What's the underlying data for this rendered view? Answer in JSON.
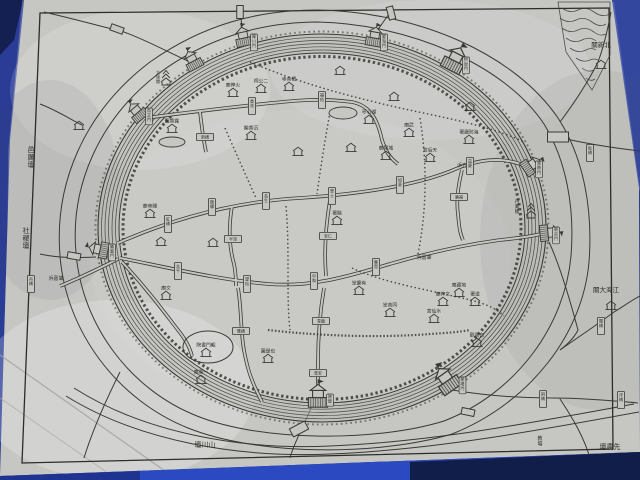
{
  "scene": {
    "description": "photograph of a hand-drawn historical Chinese walled-city map (circular city wall, moat, canals, gates) laminated sheet on blue table",
    "palette": {
      "sheet": "#c6c7c3",
      "sheet_shade": "#b7b8b4",
      "line": "#3a3a34",
      "text": "#2e2e28",
      "bg_blue": "#22357f",
      "left_blue": "#2a3c96",
      "corner_blue": "#33479f",
      "table_blue": "#2b49c0",
      "dark_blue": "#0e1838"
    }
  },
  "map": {
    "rivers": [
      "肇嘉浜",
      "方浜"
    ],
    "landmarks_outside": [
      "北新關",
      "江海大關",
      "邑厲壇",
      "社稷壇",
      "山川壇",
      "先農壇",
      "教場"
    ],
    "gates": [
      "尚文門",
      "拱辰門",
      "障川門",
      "晏海門",
      "寶帶門",
      "朝宗門",
      "朝陽門",
      "跨龍門",
      "儀鳳門"
    ],
    "features": [
      {
        "id": "label-yilitan",
        "type": "label",
        "x": 31,
        "y": 152,
        "text": "邑厲壇",
        "o": "v",
        "fs": 7
      },
      {
        "id": "label-shejitan",
        "type": "label",
        "x": 26,
        "y": 233,
        "text": "社稷壇",
        "o": "v",
        "fs": 7
      },
      {
        "id": "label-zhaojiabang-west",
        "type": "label",
        "x": 56,
        "y": 280,
        "text": "浜嘉肇",
        "o": "h",
        "fs": 5
      },
      {
        "id": "label-beixinguan",
        "type": "label",
        "x": 601,
        "y": 47,
        "text": "關新北",
        "o": "h",
        "fs": 6.5
      },
      {
        "id": "label-jianghaidaguan",
        "type": "label",
        "x": 606,
        "y": 292,
        "text": "關大海江",
        "o": "h",
        "fs": 6.5
      },
      {
        "id": "label-shanchuantan",
        "type": "label",
        "x": 205,
        "y": 447,
        "text": "壇川山",
        "o": "h",
        "fs": 7
      },
      {
        "id": "label-xiannongtan",
        "type": "label",
        "x": 610,
        "y": 449,
        "text": "壇農先",
        "o": "h",
        "fs": 7
      },
      {
        "id": "label-jiaochang",
        "type": "label",
        "x": 540,
        "y": 440,
        "text": "教場",
        "o": "v",
        "fs": 5
      },
      {
        "id": "label-zhaojiabang-east",
        "type": "label",
        "x": 424,
        "y": 259,
        "text": "浜嘉肇",
        "o": "h",
        "fs": 5
      },
      {
        "id": "label-fangbang",
        "type": "label",
        "x": 462,
        "y": 167,
        "text": "浜方",
        "o": "h",
        "fs": 5
      },
      {
        "id": "label-danfenglou",
        "type": "label",
        "x": 517,
        "y": 203,
        "text": "丹鳳樓",
        "o": "v",
        "fs": 4.5
      },
      {
        "id": "temple-huoshenmiao",
        "type": "house",
        "x": 233,
        "y": 92,
        "text": "廟神火"
      },
      {
        "id": "shrine-ergongci",
        "type": "house",
        "x": 261,
        "y": 88,
        "text": "祠公二"
      },
      {
        "id": "temple-jishansi",
        "type": "house",
        "x": 289,
        "y": 86,
        "text": "寺善積"
      },
      {
        "id": "temple-chenxiangge",
        "type": "house",
        "x": 251,
        "y": 135,
        "text": "閣香沉"
      },
      {
        "id": "pavilion-huxinting",
        "type": "house",
        "x": 369,
        "y": 119,
        "text": "亭心湖"
      },
      {
        "id": "temple-chenghuangmiao",
        "type": "house",
        "x": 386,
        "y": 155,
        "text": "廟隍城"
      },
      {
        "id": "temple-wumiao",
        "type": "house",
        "x": 409,
        "y": 132,
        "text": "廟武"
      },
      {
        "id": "office-xianshu",
        "type": "house",
        "x": 337,
        "y": 220,
        "text": "署縣"
      },
      {
        "id": "office-haifangting",
        "type": "house",
        "x": 469,
        "y": 139,
        "text": "署廳防海"
      },
      {
        "id": "temple-tianhougong",
        "type": "house",
        "x": 430,
        "y": 157,
        "text": "宮后天"
      },
      {
        "id": "garden-luxiangyuan",
        "type": "house",
        "x": 172,
        "y": 128,
        "text": "園香露"
      },
      {
        "id": "temple-guandimiao",
        "type": "house",
        "x": 150,
        "y": 213,
        "text": "廟帝關"
      },
      {
        "id": "temple-wenmiao",
        "type": "house",
        "x": 166,
        "y": 295,
        "text": "廟文"
      },
      {
        "id": "garden-yeshiyuan",
        "type": "house",
        "x": 268,
        "y": 358,
        "text": "園是也"
      },
      {
        "id": "academy-longmenshuyuan",
        "type": "house",
        "x": 206,
        "y": 352,
        "text": "院書門龍"
      },
      {
        "id": "temple-yisuan",
        "type": "house",
        "x": 201,
        "y": 379,
        "text": "庵粟一"
      },
      {
        "id": "hall-tongshantang",
        "type": "house",
        "x": 390,
        "y": 312,
        "text": "堂善同"
      },
      {
        "id": "temple-shuixiangong",
        "type": "house",
        "x": 434,
        "y": 318,
        "text": "宮仙水"
      },
      {
        "id": "temple-wenshenmiao",
        "type": "house",
        "x": 443,
        "y": 301,
        "text": "廟神文"
      },
      {
        "id": "temple-dizangan",
        "type": "house",
        "x": 459,
        "y": 292,
        "text": "庵藏地"
      },
      {
        "id": "office-daoshu",
        "type": "house",
        "x": 475,
        "y": 301,
        "text": "署道"
      },
      {
        "id": "temple-baiyunguan",
        "type": "house",
        "x": 477,
        "y": 342,
        "text": "觀雲白"
      },
      {
        "id": "hall-youqingtang",
        "type": "house",
        "x": 359,
        "y": 290,
        "text": "堂慶有"
      },
      {
        "id": "house-beixinguan",
        "type": "house",
        "x": 601,
        "y": 64,
        "text": ""
      },
      {
        "id": "house-jianghaidaguan",
        "type": "house",
        "x": 611,
        "y": 305,
        "text": ""
      },
      {
        "id": "house-yilitan",
        "type": "house",
        "x": 79,
        "y": 125,
        "text": ""
      },
      {
        "id": "house-1",
        "type": "house",
        "x": 298,
        "y": 151,
        "text": ""
      },
      {
        "id": "house-2",
        "type": "house",
        "x": 351,
        "y": 147,
        "text": ""
      },
      {
        "id": "house-3",
        "type": "house",
        "x": 470,
        "y": 106,
        "text": ""
      },
      {
        "id": "house-4",
        "type": "house",
        "x": 161,
        "y": 241,
        "text": ""
      },
      {
        "id": "house-5",
        "type": "house",
        "x": 213,
        "y": 242,
        "text": ""
      },
      {
        "id": "house-6",
        "type": "house",
        "x": 394,
        "y": 96,
        "text": ""
      },
      {
        "id": "house-7",
        "type": "house",
        "x": 340,
        "y": 70,
        "text": ""
      },
      {
        "id": "bridge-hongqiao",
        "type": "bridge",
        "x": 168,
        "y": 224,
        "o": "v",
        "text": "虹橋"
      },
      {
        "id": "bridge-guanyi",
        "type": "bridge",
        "x": 212,
        "y": 207,
        "o": "v",
        "text": "館驛"
      },
      {
        "id": "bridge-changsheng",
        "type": "bridge",
        "x": 266,
        "y": 201,
        "o": "v",
        "text": "長生"
      },
      {
        "id": "bridge-xueshi",
        "type": "bridge",
        "x": 332,
        "y": 196,
        "o": "v",
        "text": "學士"
      },
      {
        "id": "bridge-ruyi",
        "type": "bridge",
        "x": 400,
        "y": 185,
        "o": "v",
        "text": "如意"
      },
      {
        "id": "bridge-yiqing",
        "type": "bridge",
        "x": 470,
        "y": 166,
        "o": "v",
        "text": "益慶"
      },
      {
        "id": "bridge-xianghua",
        "type": "bridge",
        "x": 252,
        "y": 106,
        "o": "v",
        "text": "香花"
      },
      {
        "id": "bridge-fuyou",
        "type": "bridge",
        "x": 322,
        "y": 100,
        "o": "v",
        "text": "福佑"
      },
      {
        "id": "bridge-taiping",
        "type": "bridge",
        "x": 178,
        "y": 271,
        "o": "v",
        "text": "太平"
      },
      {
        "id": "bridge-wangxian",
        "type": "bridge",
        "x": 247,
        "y": 284,
        "o": "v",
        "text": "望仙"
      },
      {
        "id": "bridge-zhonghe",
        "type": "bridge",
        "x": 314,
        "y": 281,
        "o": "v",
        "text": "中和"
      },
      {
        "id": "bridge-jixian",
        "type": "bridge",
        "x": 376,
        "y": 267,
        "o": "v",
        "text": "集賢"
      },
      {
        "id": "bridge-banjing",
        "type": "bridge",
        "x": 233,
        "y": 239,
        "o": "h",
        "text": "半涇"
      },
      {
        "id": "bridge-huiqiao",
        "type": "bridge",
        "x": 241,
        "y": 331,
        "o": "h",
        "text": "匯橋"
      },
      {
        "id": "bridge-anren",
        "type": "bridge",
        "x": 328,
        "y": 236,
        "o": "h",
        "text": "安仁"
      },
      {
        "id": "bridge-qinglong",
        "type": "bridge",
        "x": 321,
        "y": 321,
        "o": "h",
        "text": "青龍"
      },
      {
        "id": "bridge-puan",
        "type": "bridge",
        "x": 318,
        "y": 373,
        "o": "h",
        "text": "普安"
      },
      {
        "id": "bridge-xinqiao",
        "type": "bridge",
        "x": 205,
        "y": 137,
        "o": "h",
        "text": "新橋"
      },
      {
        "id": "bridge-guangfu",
        "type": "bridge",
        "x": 459,
        "y": 197,
        "o": "h",
        "text": "廣福"
      },
      {
        "id": "bridge-diaoqiao-w",
        "type": "bridge",
        "x": 31,
        "y": 284,
        "o": "v",
        "text": "吊橋"
      },
      {
        "id": "bridge-banqiao-ne",
        "type": "bridge",
        "x": 590,
        "y": 153,
        "o": "v",
        "text": "板橋"
      },
      {
        "id": "bridge-guanqiao-e",
        "type": "bridge",
        "x": 601,
        "y": 326,
        "o": "v",
        "text": "關橋"
      },
      {
        "id": "bridge-xieqiao-se",
        "type": "bridge",
        "x": 543,
        "y": 399,
        "o": "v",
        "text": "斜橋"
      },
      {
        "id": "bridge-fuqiao-se",
        "type": "bridge",
        "x": 621,
        "y": 400,
        "o": "v",
        "text": "浮橋"
      },
      {
        "id": "bridge-plain-nw",
        "type": "bridge-plain",
        "x": 117,
        "y": 29,
        "rot": 20
      },
      {
        "id": "bridge-plain-n1",
        "type": "bridge-plain",
        "x": 240,
        "y": 12,
        "rot": 90
      },
      {
        "id": "bridge-plain-n2",
        "type": "bridge-plain",
        "x": 391,
        "y": 13,
        "rot": 75
      },
      {
        "id": "bridge-plain-w",
        "type": "bridge-plain",
        "x": 74,
        "y": 256,
        "rot": 10
      },
      {
        "id": "bridge-plain-s",
        "type": "bridge-plain",
        "x": 299,
        "y": 429,
        "rot": -28,
        "w": 17,
        "h": 9
      },
      {
        "id": "bridge-plain-ne-big",
        "type": "bridge-plain",
        "x": 558,
        "y": 137,
        "rot": 0,
        "w": 21,
        "h": 10
      },
      {
        "id": "bridge-plain-se",
        "type": "bridge-plain",
        "x": 468,
        "y": 412,
        "rot": 12
      },
      {
        "id": "gate-shangwenmen",
        "type": "gate",
        "x": 139,
        "y": 114,
        "rot": -40,
        "text": "尚文門"
      },
      {
        "id": "gate-unnamed-n",
        "type": "gate",
        "x": 194,
        "y": 63,
        "rot": -28,
        "text": ""
      },
      {
        "id": "gate-zhangchuanmen",
        "type": "gate",
        "x": 244,
        "y": 40,
        "rot": -12,
        "text": "障川門"
      },
      {
        "id": "gate-yanhaimen",
        "type": "gate",
        "x": 374,
        "y": 40,
        "rot": 10,
        "text": "晏海門"
      },
      {
        "id": "gate-gongchenmen",
        "type": "gate",
        "x": 453,
        "y": 63,
        "rot": 27,
        "s": 1.3,
        "text": "拱辰門"
      },
      {
        "id": "gate-baodaimen",
        "type": "gate",
        "x": 529,
        "y": 167,
        "rot": 55,
        "text": "寶帶門"
      },
      {
        "id": "gate-chaozongmen",
        "type": "gate",
        "x": 546,
        "y": 233,
        "rot": 85,
        "text": "朝宗門"
      },
      {
        "id": "gate-chaoyangmen",
        "type": "gate",
        "x": 449,
        "y": 383,
        "rot": -35,
        "s": 1.35,
        "text": "朝陽門"
      },
      {
        "id": "gate-kualongmen",
        "type": "gate",
        "x": 318,
        "y": 400,
        "rot": 0,
        "s": 1.2,
        "text": "跨龍"
      },
      {
        "id": "gate-yifengmen",
        "type": "gate",
        "x": 102,
        "y": 250,
        "rot": -78,
        "text": "儀鳳門"
      },
      {
        "id": "tower-dajingge",
        "type": "tower",
        "x": 166,
        "y": 82,
        "text": "大境閣"
      },
      {
        "id": "tower-danfenglou",
        "type": "tower",
        "x": 531,
        "y": 215,
        "text": ""
      },
      {
        "id": "pond-west",
        "type": "pond",
        "x": 172,
        "y": 142,
        "rx": 13,
        "ry": 5
      },
      {
        "id": "pond-huxin",
        "type": "pond",
        "x": 343,
        "y": 113,
        "rx": 14,
        "ry": 6
      },
      {
        "id": "compound-longmen",
        "type": "oval",
        "x": 208,
        "y": 347,
        "rx": 25,
        "ry": 16
      }
    ]
  }
}
